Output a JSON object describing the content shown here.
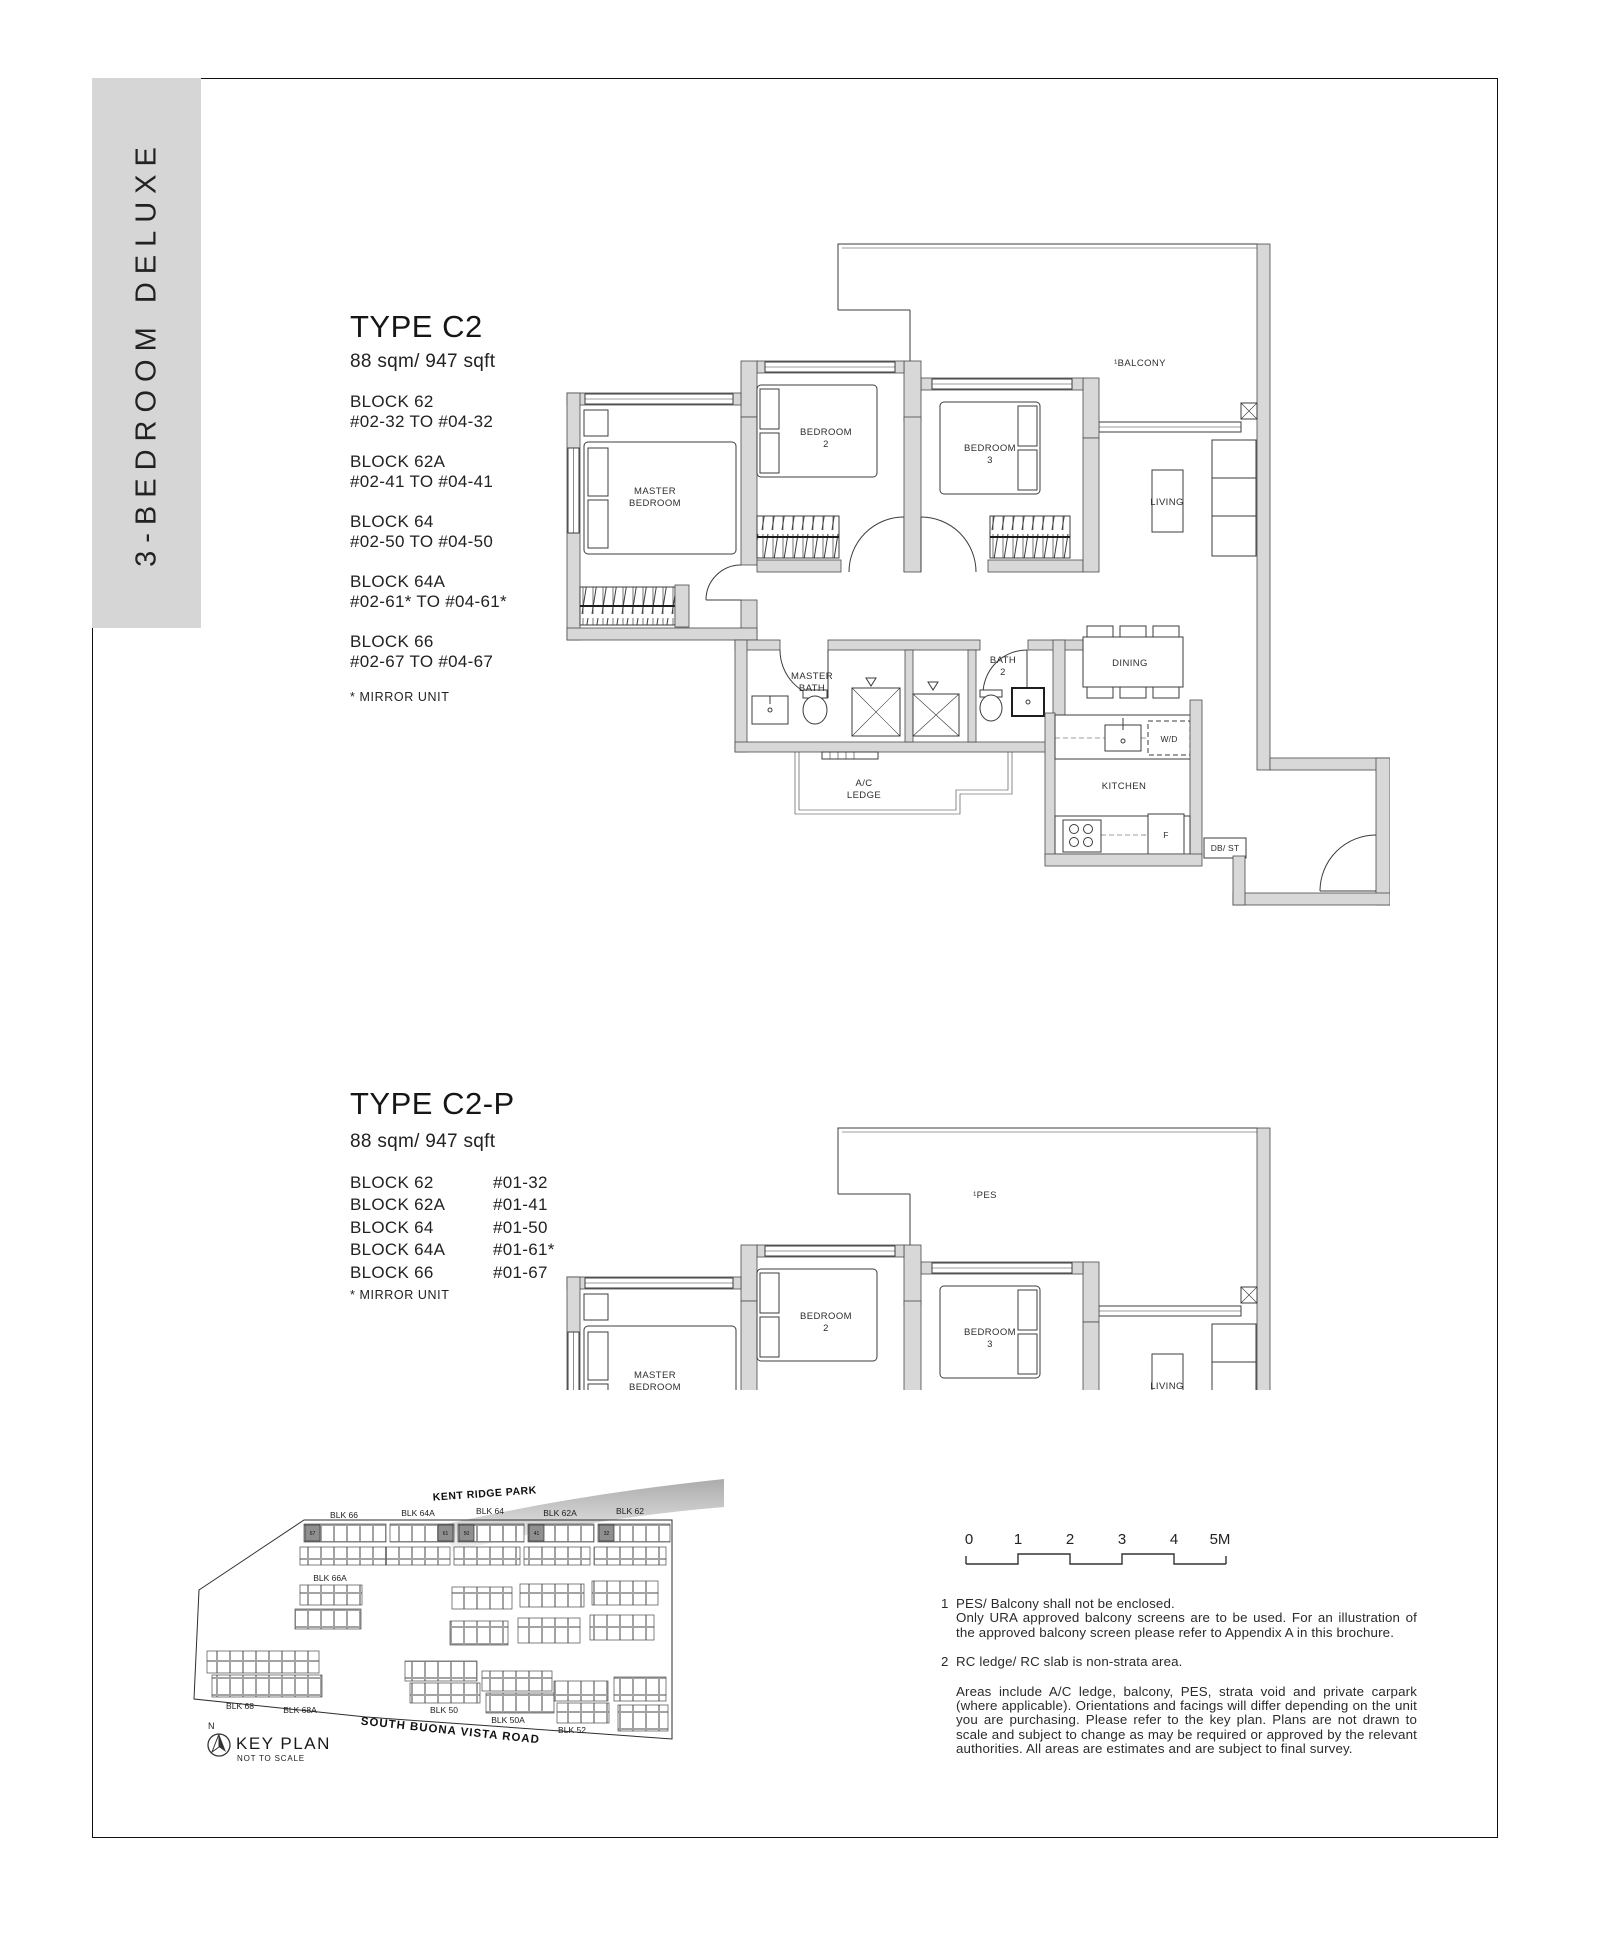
{
  "sidebar": {
    "label": "3 - B E D R O O M   D E L U X E",
    "label_plain": "3-BEDROOM DELUXE"
  },
  "sections": {
    "c2": {
      "title": "TYPE C2",
      "area": "88 sqm/ 947 sqft",
      "blocks": [
        {
          "name": "BLOCK 62",
          "range": "#02-32 TO #04-32"
        },
        {
          "name": "BLOCK 62A",
          "range": "#02-41 TO #04-41"
        },
        {
          "name": "BLOCK 64",
          "range": "#02-50 TO #04-50"
        },
        {
          "name": "BLOCK 64A",
          "range": "#02-61* TO #04-61*"
        },
        {
          "name": "BLOCK 66",
          "range": "#02-67 TO #04-67"
        }
      ],
      "mirror_note": "* MIRROR UNIT"
    },
    "c2p": {
      "title": "TYPE C2-P",
      "area": "88 sqm/ 947 sqft",
      "blocks": [
        {
          "name": "BLOCK 62",
          "unit": "#01-32"
        },
        {
          "name": "BLOCK 62A",
          "unit": "#01-41"
        },
        {
          "name": "BLOCK 64",
          "unit": "#01-50"
        },
        {
          "name": "BLOCK 64A",
          "unit": "#01-61*"
        },
        {
          "name": "BLOCK 66",
          "unit": "#01-67"
        }
      ],
      "mirror_note": "* MIRROR UNIT"
    }
  },
  "plan": {
    "master_1": "MASTER",
    "master_2": "BEDROOM",
    "bedroom2_1": "BEDROOM",
    "bedroom2_2": "2",
    "bedroom3_1": "BEDROOM",
    "bedroom3_2": "3",
    "living": "LIVING",
    "dining": "DINING",
    "kitchen": "KITCHEN",
    "masterbath_1": "MASTER",
    "masterbath_2": "BATH",
    "bath2_1": "BATH",
    "bath2_2": "2",
    "acledge_1": "A/C",
    "acledge_2": "LEDGE",
    "wd": "W/D",
    "fridge": "F",
    "dbst": "DB/ ST",
    "balcony": "¹BALCONY",
    "pes": "¹PES"
  },
  "keyplan": {
    "park": "KENT RIDGE PARK",
    "road": "SOUTH BUONA VISTA ROAD",
    "top_blocks": [
      "BLK 66",
      "BLK 64A",
      "BLK 64",
      "BLK 62A",
      "BLK 62"
    ],
    "blk66a": "BLK 66A",
    "blk68": "BLK 68",
    "blk68a": "BLK 68A",
    "blk50": "BLK 50",
    "blk50a": "BLK 50A",
    "blk52": "BLK 52",
    "stacks": [
      "67",
      "61",
      "50",
      "41",
      "32"
    ],
    "north": "N",
    "title": "KEY PLAN",
    "subtitle": "NOT TO SCALE"
  },
  "scalebar": {
    "ticks": [
      "0",
      "1",
      "2",
      "3",
      "4",
      "5M"
    ]
  },
  "notes": {
    "n1_num": "1",
    "n1_line1": "PES/ Balcony shall not be enclosed.",
    "n1_line2": "Only URA approved balcony screens are to be used. For an illustration of the approved balcony screen please refer to Appendix A in this brochure.",
    "n2_num": "2",
    "n2_text": "RC ledge/ RC slab is non-strata area.",
    "para": "Areas include A/C ledge, balcony, PES, strata void and private carpark (where applicable). Orientations and facings will differ depending on the unit you are purchasing. Please refer to the key plan. Plans are not drawn to scale and subject to change as may be required or approved by the relevant authorities. All areas are estimates and are subject to final survey."
  }
}
